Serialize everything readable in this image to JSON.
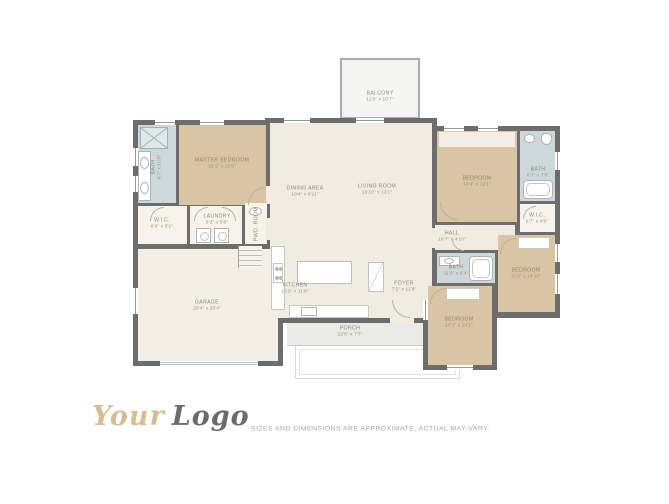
{
  "branding": {
    "logo_your": "Your",
    "logo_word": "Logo"
  },
  "disclaimer": "SIZES AND DIMENSIONS ARE APPROXIMATE, ACTUAL MAY VARY.",
  "colors": {
    "wall": "#6d6d6d",
    "bedroom_floor": "#d9c4a3",
    "bath_floor": "#ccd8da",
    "living_floor": "#f1ece2",
    "porch_floor": "#eaeae7",
    "logo_tan": "#d9bd92",
    "logo_gray": "#6b6b6b",
    "label_text": "#8d8575"
  },
  "rooms": {
    "balcony": {
      "name": "BALCONY",
      "dims": "11'9\" x 10'7\""
    },
    "master_bedroom": {
      "name": "MASTER BEDROOM",
      "dims": "15'1\" x 12'8\""
    },
    "master_bath": {
      "name": "BATH",
      "dims": "6'7\" x 10'0\""
    },
    "master_wic": {
      "name": "W.I.C.",
      "dims": "6'9\" x 5'1\""
    },
    "laundry": {
      "name": "LAUNDRY",
      "dims": "6'2\" x 5'8\""
    },
    "pwd_room": {
      "name": "PWD. ROOM",
      "dims": ""
    },
    "dining_area": {
      "name": "DINING AREA",
      "dims": "10'4\" x 9'11\""
    },
    "living_room": {
      "name": "LIVING ROOM",
      "dims": "16'10\" x 13'1\""
    },
    "kitchen": {
      "name": "KITCHEN",
      "dims": "15'9\" x 11'8\""
    },
    "foyer": {
      "name": "FOYER",
      "dims": "7'2\" x 11'8\""
    },
    "garage": {
      "name": "GARAGE",
      "dims": "20'4\" x 20'4\""
    },
    "porch": {
      "name": "PORCH",
      "dims": "22'6\" x 7'7\""
    },
    "bedroom_ne": {
      "name": "BEDROOM",
      "dims": "14'4\" x 12'1\""
    },
    "bath_ne": {
      "name": "BATH",
      "dims": "6'7\" x 7'8\""
    },
    "wic_ne": {
      "name": "W.I.C.",
      "dims": "6'7\" x 4'9\""
    },
    "hall": {
      "name": "HALL",
      "dims": "10'7\" x 4'10\""
    },
    "bath_hall": {
      "name": "BATH",
      "dims": "11'1\" x 6'4\""
    },
    "bedroom_e": {
      "name": "BEDROOM",
      "dims": "11'6\" x 14'10\""
    },
    "bedroom_s": {
      "name": "BEDROOM",
      "dims": "10'1\" x 14'1\""
    }
  }
}
